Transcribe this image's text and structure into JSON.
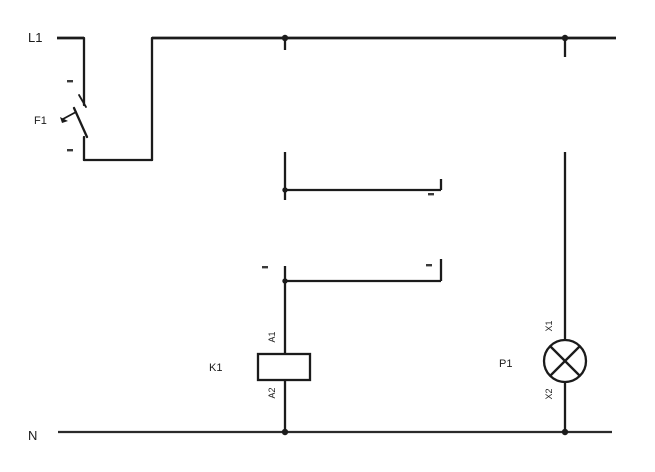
{
  "diagram": {
    "type": "electrical-control-circuit",
    "background": "#ffffff",
    "line_color": "#1b1b1b",
    "rails": {
      "top": {
        "label": "L1"
      },
      "bottom": {
        "label": "N"
      }
    },
    "components": {
      "breaker": {
        "label": "F1"
      },
      "coil": {
        "label": "K1",
        "terminals": {
          "top": "A1",
          "bottom": "A2"
        }
      },
      "lamp": {
        "label": "P1",
        "terminals": {
          "top": "X1",
          "bottom": "X2"
        }
      }
    }
  }
}
